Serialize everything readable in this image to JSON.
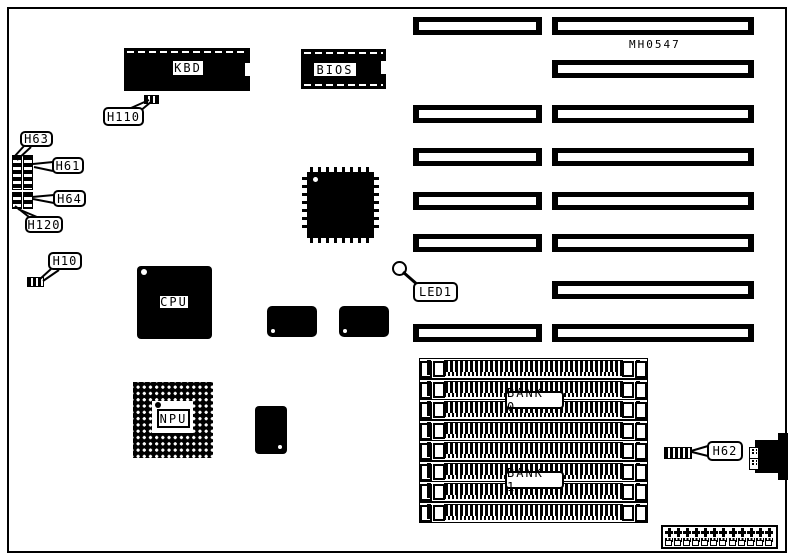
{
  "board": {
    "id_label": "MH0547",
    "colors": {
      "ink": "#000000",
      "paper": "#ffffff"
    },
    "type": "motherboard-layout-diagram"
  },
  "chips": {
    "kbd": {
      "label": "KBD"
    },
    "bios": {
      "label": "BIOS"
    },
    "cpu": {
      "label": "CPU"
    },
    "npu": {
      "label": "NPU"
    }
  },
  "callouts": {
    "h110": {
      "label": "H110"
    },
    "h63": {
      "label": "H63"
    },
    "h61": {
      "label": "H61"
    },
    "h64": {
      "label": "H64"
    },
    "h120": {
      "label": "H120"
    },
    "h10": {
      "label": "H10"
    },
    "led1": {
      "label": "LED1"
    },
    "h62": {
      "label": "H62"
    }
  },
  "memory": {
    "bank0_label": "BANK 0",
    "bank1_label": "BANK 1",
    "simm_socket_count": 8
  },
  "expansion_slots": {
    "left_column_count": 6,
    "right_column_count": 8
  },
  "power_connector": {
    "pin_count": 12
  }
}
